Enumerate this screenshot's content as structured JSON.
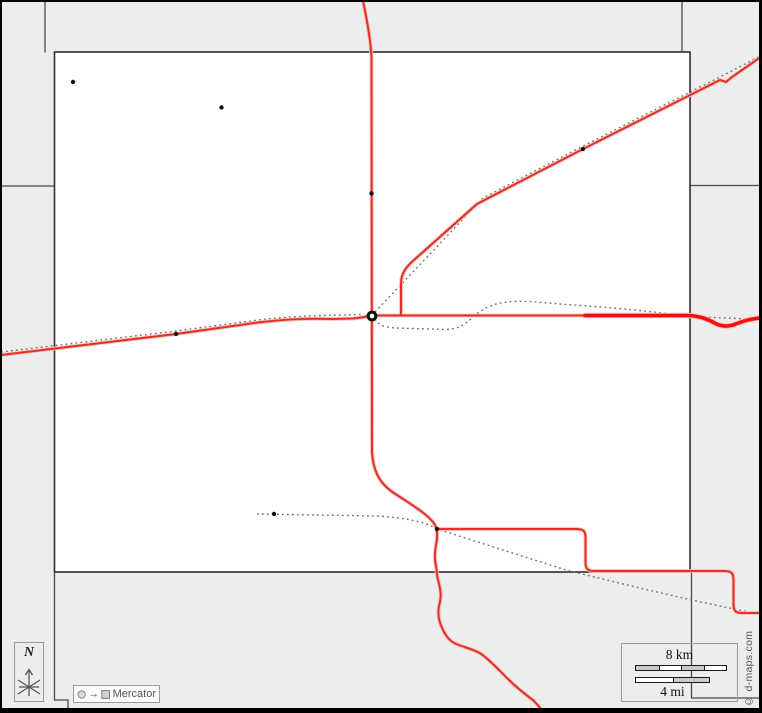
{
  "meta": {
    "credit": "© d-maps.com",
    "projection_label": "Mercator",
    "north_label": "N"
  },
  "scalebar": {
    "km": "8 km",
    "mi": "4 mi"
  },
  "map": {
    "width": 762,
    "height": 713,
    "colors": {
      "bg": "#ededed",
      "county_fill": "#ffffff",
      "county_stroke": "#2d2d2d",
      "border": "#4a4a4a",
      "road": "#e23227",
      "road_halo": "#f6bcb6",
      "highway": "#f50f0f",
      "railroad": "#7b6c60",
      "town": "#111111",
      "frame": "#000000"
    },
    "county": {
      "x": 54.5,
      "y": 52,
      "w": 635.5,
      "h": 520
    },
    "frame_rects": [
      [
        0,
        0,
        762,
        2
      ],
      [
        0,
        0,
        2,
        713
      ],
      [
        759,
        0,
        3,
        713
      ],
      [
        0,
        708,
        762,
        5
      ]
    ],
    "borders": [
      {
        "name": "border-north-left",
        "d": "M45,1 L45,52.5"
      },
      {
        "name": "border-west",
        "d": "M1,186 L54.5,186"
      },
      {
        "name": "border-north-right",
        "d": "M682,1 L682,52.5"
      },
      {
        "name": "border-east",
        "d": "M690.5,185.5 L760,185.5"
      },
      {
        "name": "border-southeast",
        "d": "M691.5,572 L691.5,698 L760,698"
      },
      {
        "name": "border-southwest",
        "d": "M54.5,572 L54.5,700 L68,700 L68,709"
      }
    ],
    "railroads": [
      {
        "name": "railroad-west",
        "d": "M1,352 L176,331 L258,320 C295,315.5 330,315.5 362,314.5"
      },
      {
        "name": "railroad-northeast",
        "d": "M375,312 L483,198 L583,146 L722,76 L760,56"
      },
      {
        "name": "railroad-east",
        "d": "M375,319 C378,325.5 386,327.5 396,328 L445,329.5 C456,329.5 463,326 471,319 C479,311 488,306 498,303.5 C511,300.5 526,301 541,302.5 L601,307 C631,309.5 661,312.5 691,316.5 L760,319.5"
      },
      {
        "name": "railroad-south",
        "d": "M257,514 L377,516 C407,518 426,522 437,529 L566,570 C631,586 700,603 760,614"
      }
    ],
    "roads": [
      {
        "name": "road-main-north-south",
        "w": 2,
        "d": "M363,1 C367,20 370.5,38 371.5,57 L372,452 C373,470 379,482 391,491 C407,502 425,512 433,522 C437,526.5 438,533 436.5,542 C435,551 434,558 436,566 L437.5,578 C441,590 441.5,597 439.5,604 C437,613 438.5,621 443,630 C447,638 451,642 457.5,644.5 C465,647.5 474,649.5 480.5,653.5 C488,658.5 495.5,666.5 503.5,674.5 C512,683.5 524,693.5 533.5,700.5 L543,711"
      },
      {
        "name": "road-west",
        "w": 2,
        "d": "M1,355 L176,334 L258,322.5 C290,318.5 312,318.5 332,319 L353,318.5 C361,318 365,317 369,316"
      },
      {
        "name": "road-east-thin",
        "w": 2,
        "d": "M375,315.5 L586,315.5"
      },
      {
        "name": "road-east-highway",
        "w": 3.6,
        "highway": true,
        "d": "M585,315.5 L688,315.5 C700,316 707.5,319 715.5,323.5 C721.5,326.5 729,327 737,323.5 C745,320.5 752,318.5 760,318"
      },
      {
        "name": "road-northeast",
        "w": 2,
        "d": "M401,315 L401,284 C401,273 406.5,266.5 414,260 L477,204 L583,149 L720,80 L726,82 L732,77 L760,57.5"
      },
      {
        "name": "road-south-loop",
        "w": 2,
        "d": "M437,529 L576,529 C583.5,529 585.5,531 585.5,538 L585.5,562 C585.5,569 587.5,571 594.5,571 L724,571 C731.5,571 733.5,573 733.5,580 L733.5,604 C733.5,611 735.5,613 742.5,613 L760,613"
      }
    ],
    "towns": [
      [
        73,
        82
      ],
      [
        221.5,
        107.5
      ],
      [
        371.5,
        193.5
      ],
      [
        583,
        149
      ],
      [
        176,
        334
      ],
      [
        274,
        514
      ],
      [
        437,
        529
      ]
    ],
    "county_seat": [
      372,
      316
    ]
  }
}
